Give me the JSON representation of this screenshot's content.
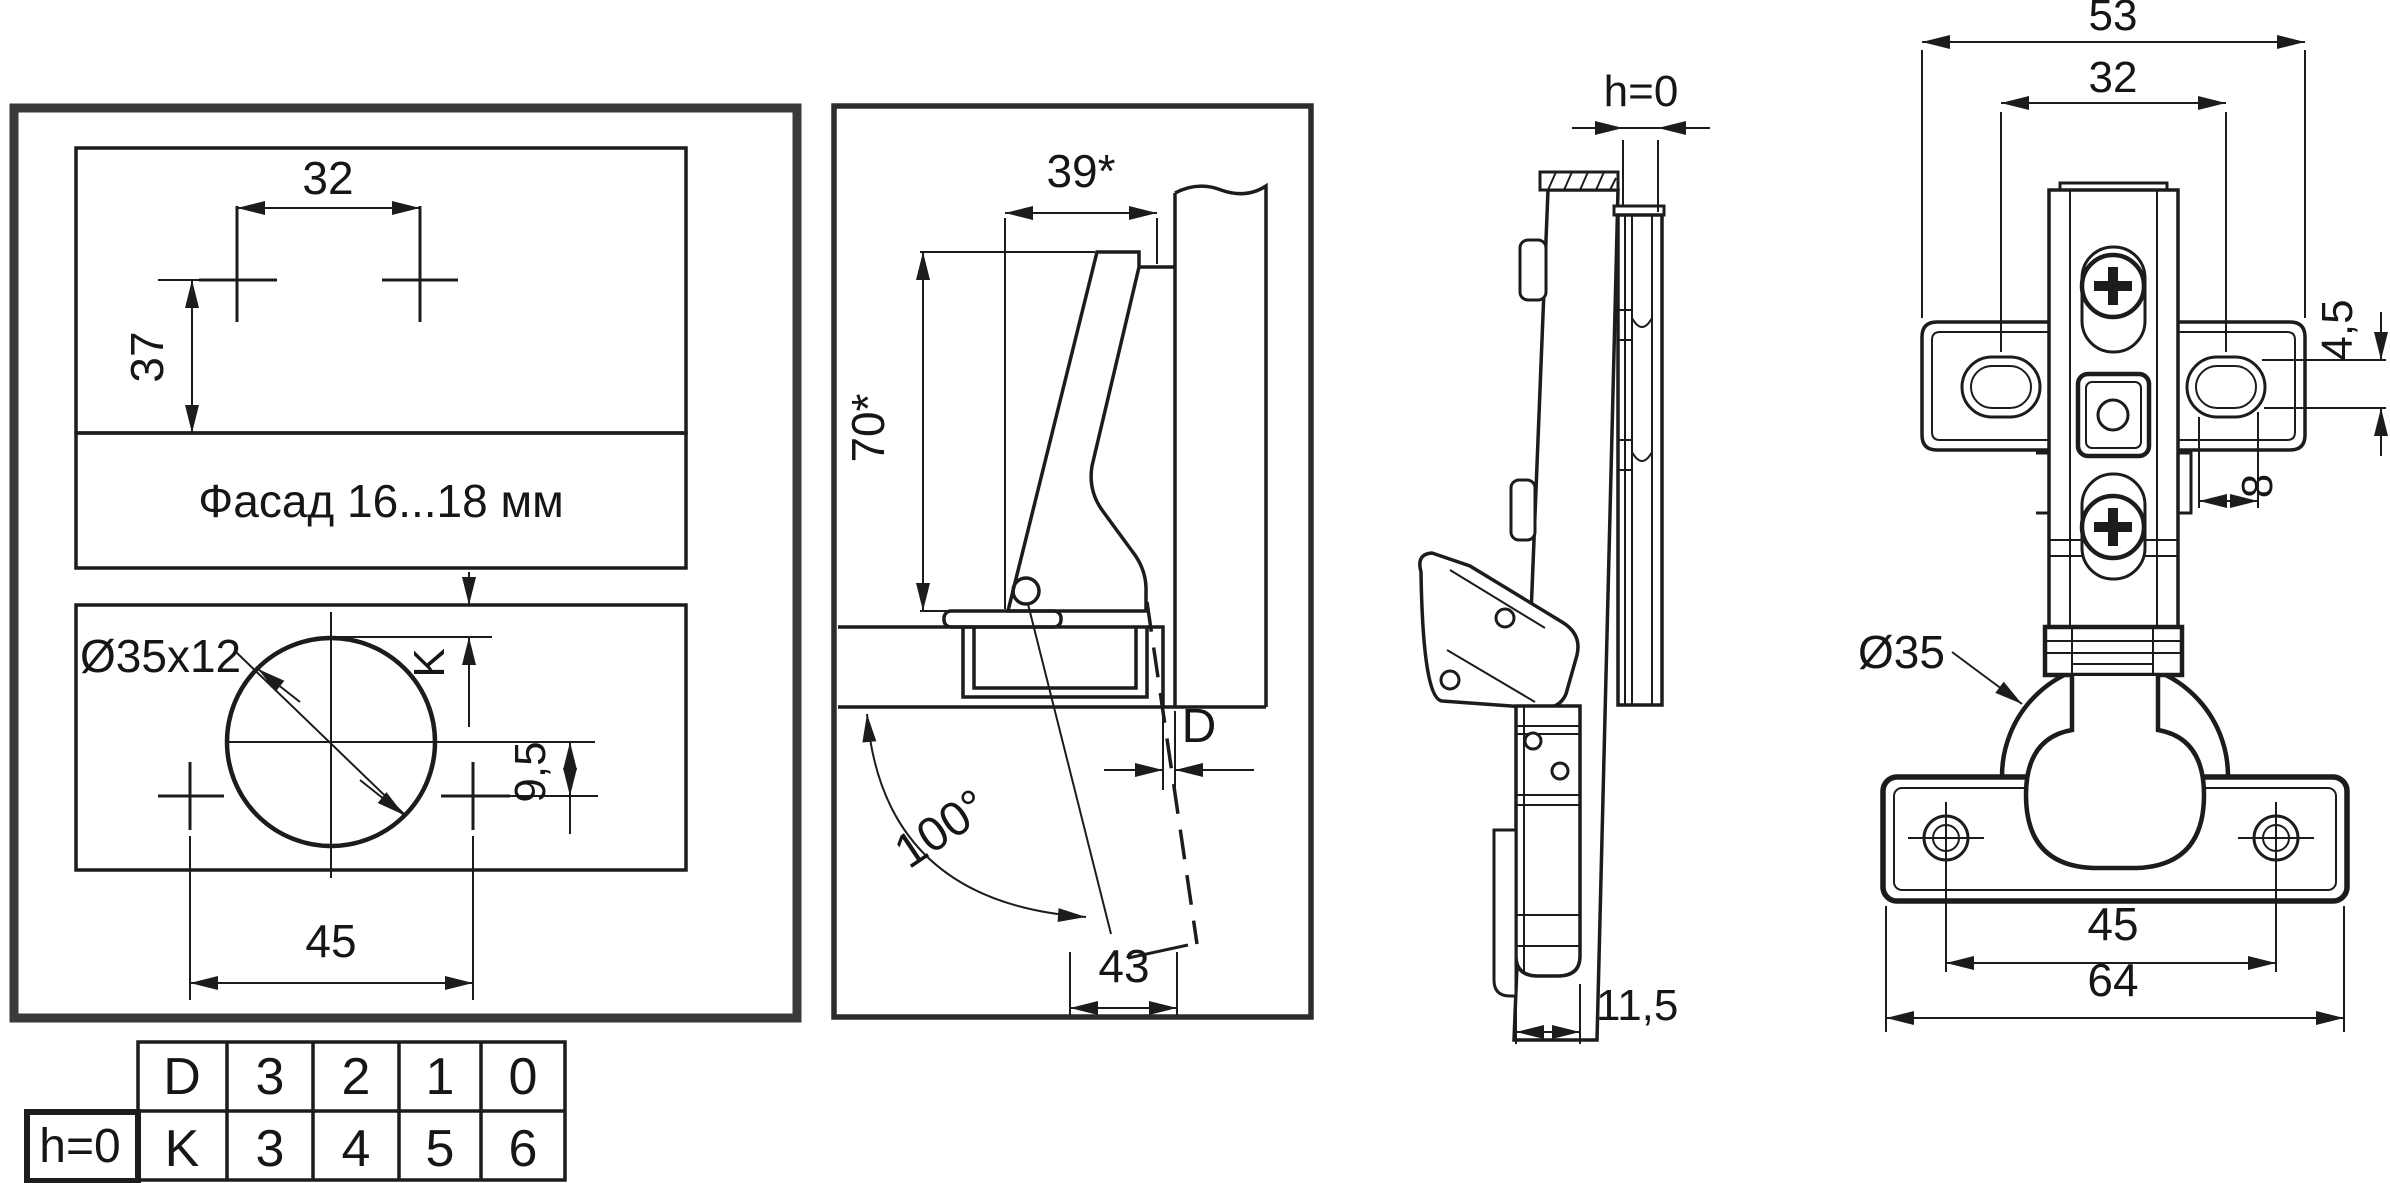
{
  "colors": {
    "ink": "#1c1c1c",
    "frame": "#3a3a3a",
    "background": "#ffffff"
  },
  "drilling_template": {
    "hole_spacing": "32",
    "vertical_offset": "37",
    "facade_label": "Фасад 16...18 мм",
    "cup_hole_label": "Ø35x12",
    "cup_edge_distance_label": "K",
    "hole_offset": "9,5",
    "screw_spacing": "45"
  },
  "offset_table": {
    "condition_label": "h=0",
    "rows": [
      {
        "header": "D",
        "values": [
          "3",
          "2",
          "1",
          "0"
        ]
      },
      {
        "header": "K",
        "values": [
          "3",
          "4",
          "5",
          "6"
        ]
      }
    ]
  },
  "section_view": {
    "arm_depth": "39*",
    "hinge_height": "70*",
    "opening_angle": "100°",
    "gap_label": "D",
    "door_clearance": "43"
  },
  "side_view": {
    "overlay_label": "h=0",
    "cup_depth": "11,5"
  },
  "front_view": {
    "plate_width": "53",
    "plate_hole_spacing": "32",
    "slot_height": "4,5",
    "slot_offset": "8",
    "cup_diameter": "Ø35",
    "cup_screw_spacing": "45",
    "cup_flange_width": "64"
  }
}
